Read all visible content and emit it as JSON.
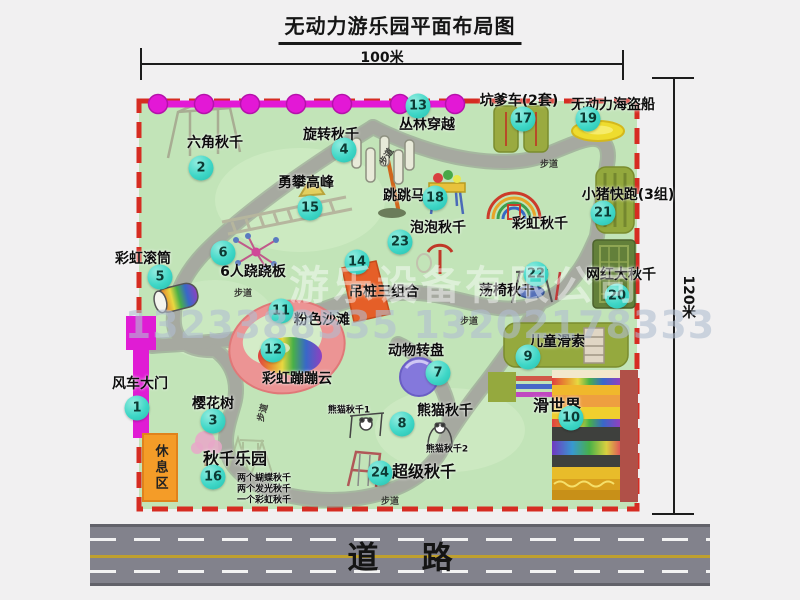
{
  "title": "无动力游乐园平面布局图",
  "dims": {
    "top": "100米",
    "right": "120米"
  },
  "road": {
    "label": "道    路"
  },
  "watermark": {
    "company": "游乐设备有限公司",
    "phone": "1323388535 13202178333"
  },
  "rest_area": "休息区",
  "trail": "步道",
  "attractions": {
    "a1": {
      "num": "1",
      "name": "风车大门"
    },
    "a2": {
      "num": "2",
      "name": "六角秋千"
    },
    "a3": {
      "num": "3",
      "name": "樱花树"
    },
    "a4": {
      "num": "4",
      "name": "旋转秋千"
    },
    "a5": {
      "num": "5",
      "name": "彩虹滚筒"
    },
    "a6": {
      "num": "6",
      "name": "6人跷跷板"
    },
    "a7": {
      "num": "7",
      "name": "动物转盘"
    },
    "a8": {
      "num": "8",
      "name": "熊猫秋千"
    },
    "a9": {
      "num": "9",
      "name": "儿童滑索"
    },
    "a10": {
      "num": "10",
      "name": "滑世界"
    },
    "a11": {
      "num": "11",
      "name": "粉色沙滩"
    },
    "a12": {
      "num": "12",
      "name": "彩虹蹦蹦云"
    },
    "a13": {
      "num": "13",
      "name": "丛林穿越"
    },
    "a14": {
      "num": "14",
      "name": "吊桩三组合"
    },
    "a15": {
      "num": "15",
      "name": "勇攀高峰"
    },
    "a16": {
      "num": "16",
      "name": "秋千乐园"
    },
    "a17": {
      "num": "17",
      "name": "坑爹车(2套)"
    },
    "a18": {
      "num": "18",
      "name": "跳跳马"
    },
    "a19": {
      "num": "19",
      "name": "无动力海盗船"
    },
    "a20": {
      "num": "20",
      "name": "网红大秋千"
    },
    "a21": {
      "num": "21",
      "name": "小猪快跑(3组)"
    },
    "a22": {
      "num": "22",
      "name": "荡椅秋千"
    },
    "a23": {
      "num": "23",
      "name": "泡泡秋千"
    },
    "a24": {
      "num": "24",
      "name": "超级秋千"
    },
    "rainbow_swing": {
      "name": "彩虹秋千"
    },
    "panda1": "熊猫秋千1",
    "panda2": "熊猫秋千2"
  },
  "swing_notes": [
    "两个蝴蝶秋千",
    "两个发光秋千",
    "一个彩虹秋千"
  ]
}
